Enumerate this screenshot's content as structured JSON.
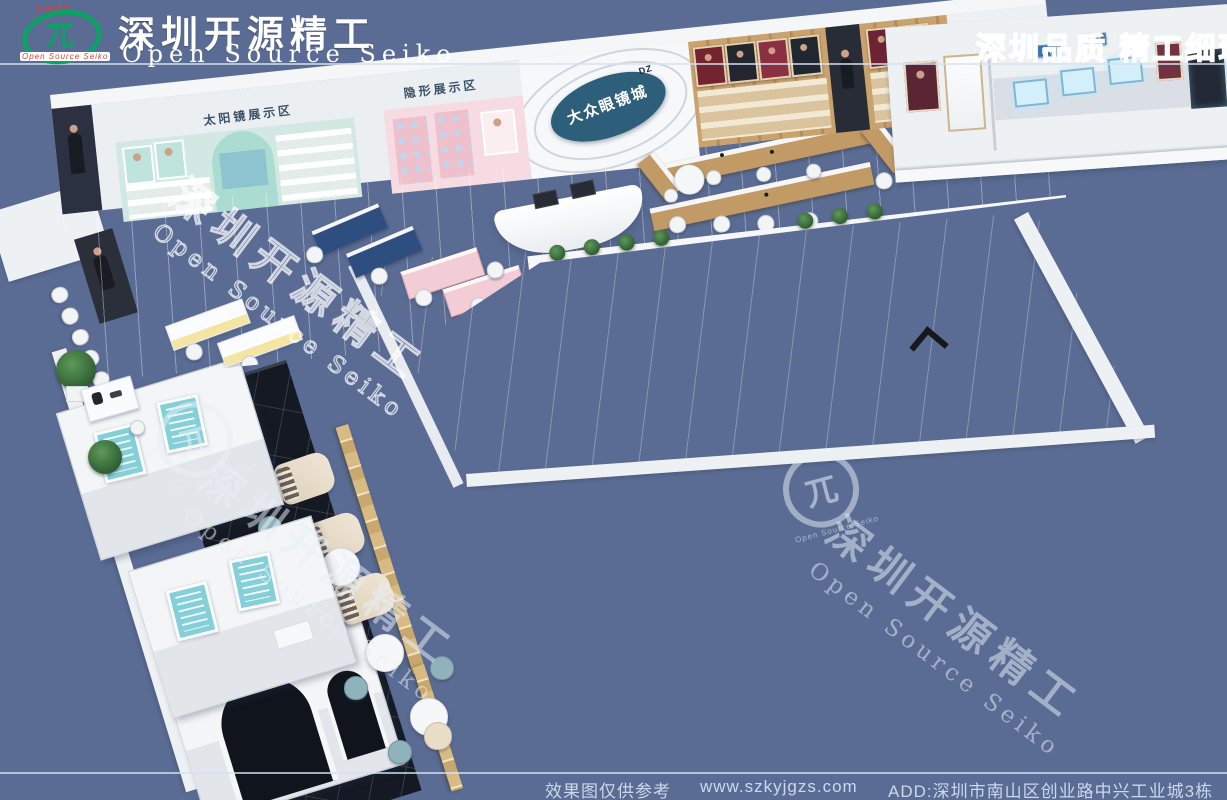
{
  "header": {
    "brand_chinese": "深圳开源精工",
    "brand_english": "Open Source Seiko",
    "emblem": {
      "top_text": "开源精工",
      "glyph": "兀",
      "bottom_text": "Open Source Seiko"
    },
    "slogan": "深圳品质 精工细琢"
  },
  "store": {
    "signs": {
      "sunglasses_zone": "太阳镜展示区",
      "contact_zone": "隐形展示区"
    },
    "logo_wall": {
      "abbr": "DZ",
      "name": "大众眼镜城"
    }
  },
  "watermark": {
    "chinese": "深圳开源精工",
    "english": "Open Source Seiko",
    "logo_glyph": "兀",
    "logo_caption": "Open Source Seiko"
  },
  "footer": {
    "disclaimer": "效果图仅供参考",
    "website": "www.szkyjgzs.com",
    "address": "ADD:深圳市南山区创业路中兴工业城3栋"
  },
  "colors": {
    "background": "#5a6c94",
    "logo_green": "#0ca265",
    "logo_red": "#d8433b",
    "ellipse_teal": "#2d5f7a",
    "zone_mint": "#d2e9e3",
    "zone_pink": "#f6dbe2",
    "wood": "#c9a26e",
    "sign_blue": "#3f74a8",
    "marble_black": "#141923",
    "gold": "#d3b47c",
    "floor_gray": "#c3c8cf"
  }
}
